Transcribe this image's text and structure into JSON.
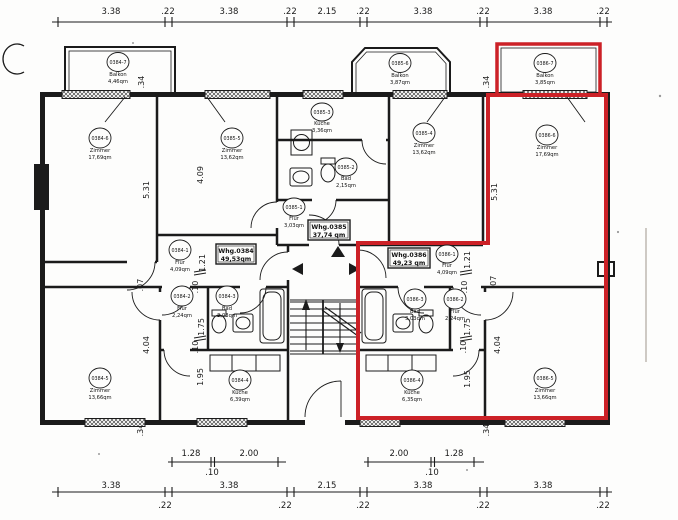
{
  "drawing": {
    "colors": {
      "line": "#1b1b1b",
      "highlight": "#cc2127"
    },
    "apartments": [
      {
        "name": "Whg.0384",
        "area": "49,53qm",
        "rooms": [
          {
            "num": "0384-7",
            "type": "Balkon",
            "area": "4,46qm"
          },
          {
            "num": "0384-6",
            "type": "Zimmer",
            "area": "17,69qm"
          },
          {
            "num": "0384-1",
            "type": "Flur",
            "area": "4,09qm"
          },
          {
            "num": "0384-2",
            "type": "Flur",
            "area": "2,24qm"
          },
          {
            "num": "0384-3",
            "type": "Bad",
            "area": "3,03qm"
          },
          {
            "num": "0384-4",
            "type": "Küche",
            "area": "6,39qm"
          },
          {
            "num": "0384-5",
            "type": "Zimmer",
            "area": "13,66qm"
          }
        ]
      },
      {
        "name": "Whg.0385",
        "area": "37,74 qm",
        "rooms": [
          {
            "num": "0385-6",
            "type": "Balkon",
            "area": "3,87qm"
          },
          {
            "num": "0385-5",
            "type": "Zimmer",
            "area": "13,62qm"
          },
          {
            "num": "0385-3",
            "type": "Küche",
            "area": "3,36qm"
          },
          {
            "num": "0385-2",
            "type": "Bad",
            "area": "2,15qm"
          },
          {
            "num": "0385-1",
            "type": "Flur",
            "area": "3,03qm"
          },
          {
            "num": "0385-4",
            "type": "Zimmer",
            "area": "13,62qm"
          }
        ]
      },
      {
        "name": "Whg.0386",
        "area": "49,23 qm",
        "rooms": [
          {
            "num": "0386-7",
            "type": "Balkon",
            "area": "3,85qm"
          },
          {
            "num": "0386-6",
            "type": "Zimmer",
            "area": "17,69qm"
          },
          {
            "num": "0386-1",
            "type": "Flur",
            "area": "4,09qm"
          },
          {
            "num": "0386-3",
            "type": "Bad",
            "area": "3,03qm"
          },
          {
            "num": "0386-2",
            "type": "Flur",
            "area": "2,24qm"
          },
          {
            "num": "0386-4",
            "type": "Küche",
            "area": "6,35qm"
          },
          {
            "num": "0386-5",
            "type": "Zimmer",
            "area": "13,66qm"
          }
        ]
      }
    ],
    "dims": {
      "top": [
        "3.38",
        ".22",
        "3.38",
        ".22",
        "2.15",
        ".22",
        "3.38",
        ".22",
        "3.38",
        ".22"
      ],
      "bottom": [
        "3.38",
        ".22",
        "3.38",
        ".22",
        "2.15",
        ".22",
        "3.38",
        ".22",
        "3.38",
        ".22"
      ],
      "inner_left": [
        "1.28",
        ".10",
        "2.00"
      ],
      "inner_right": [
        "2.00",
        ".10",
        "1.28"
      ],
      "vertical": [
        "5.31",
        "4.09",
        "5.31",
        "1.21",
        ".10",
        "1.75",
        ".10",
        "1.95",
        ".07",
        "4.04",
        "1.21",
        ".10",
        "1.75",
        ".10",
        "1.95",
        ".07",
        "4.04",
        ".34",
        ".34",
        ".34",
        ".34"
      ]
    }
  }
}
